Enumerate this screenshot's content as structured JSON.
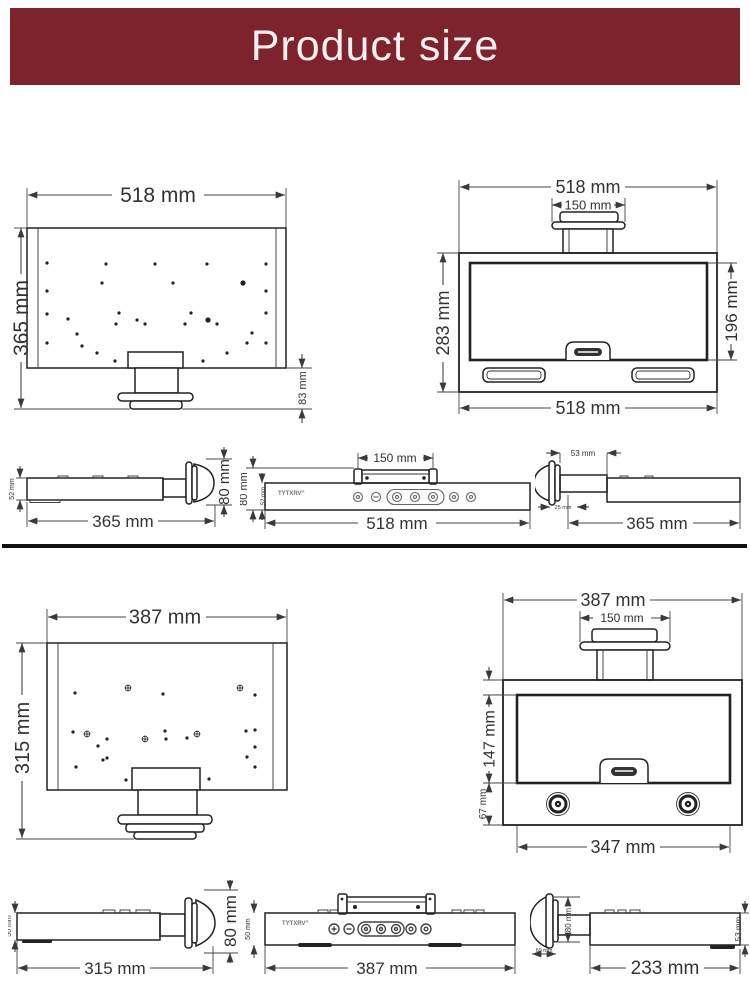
{
  "header": {
    "title": "Product size"
  },
  "brand": {
    "name": "TYTXRV",
    "mark": "®"
  },
  "unit_a": {
    "back": {
      "width": "518 mm",
      "height": "365 mm",
      "mount_height": "83 mm"
    },
    "front": {
      "width_top": "518 mm",
      "mount_width": "150 mm",
      "height": "283 mm",
      "door_height": "196 mm",
      "width_bottom": "518 mm"
    },
    "side_left": {
      "body_thickness": "52 mm",
      "mount_depth": "80 mm",
      "length": "365 mm"
    },
    "top": {
      "mount_width": "150 mm",
      "mount_depth": "80 mm",
      "body_thickness": "52 mm",
      "length": "518 mm"
    },
    "side_right": {
      "neck_length": "53 mm",
      "flange_depth": "25 mm",
      "length": "365 mm"
    }
  },
  "unit_b": {
    "back": {
      "width": "387 mm",
      "height": "315 mm"
    },
    "front": {
      "width_top": "387 mm",
      "mount_width": "150 mm",
      "door_height": "147 mm",
      "base_height": "67 mm",
      "width_bottom": "347 mm"
    },
    "side_left": {
      "body_thickness": "50 mm",
      "mount_depth": "80 mm",
      "length": "315 mm"
    },
    "top": {
      "body_thickness": "50 mm",
      "length": "387 mm"
    },
    "side_right": {
      "mount_depth": "80 mm",
      "body_thickness": "53 mm",
      "flange_depth": "69 mm",
      "length": "233 mm"
    }
  }
}
